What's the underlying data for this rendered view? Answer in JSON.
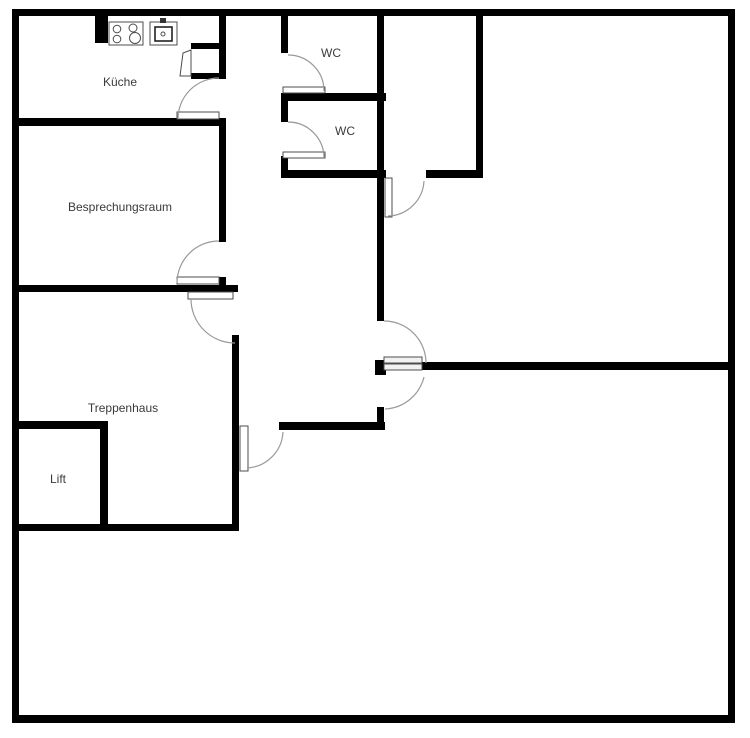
{
  "plan": {
    "type": "floor-plan",
    "rooms": [
      {
        "id": "kueche",
        "label": "Küche"
      },
      {
        "id": "besprechungsraum",
        "label": "Besprechungsraum"
      },
      {
        "id": "wc-top",
        "label": "WC"
      },
      {
        "id": "wc-bottom",
        "label": "WC"
      },
      {
        "id": "treppenhaus",
        "label": "Treppenhaus"
      },
      {
        "id": "lift",
        "label": "Lift"
      }
    ],
    "icons": [
      "stove-icon",
      "sink-icon",
      "door-leaf",
      "door-swing-arc"
    ],
    "colors": {
      "wall": "#000000",
      "background": "#ffffff",
      "label_text": "#3a3a3a",
      "door_arc": "#999999",
      "door_leaf_border": "#4d4d4d"
    }
  }
}
